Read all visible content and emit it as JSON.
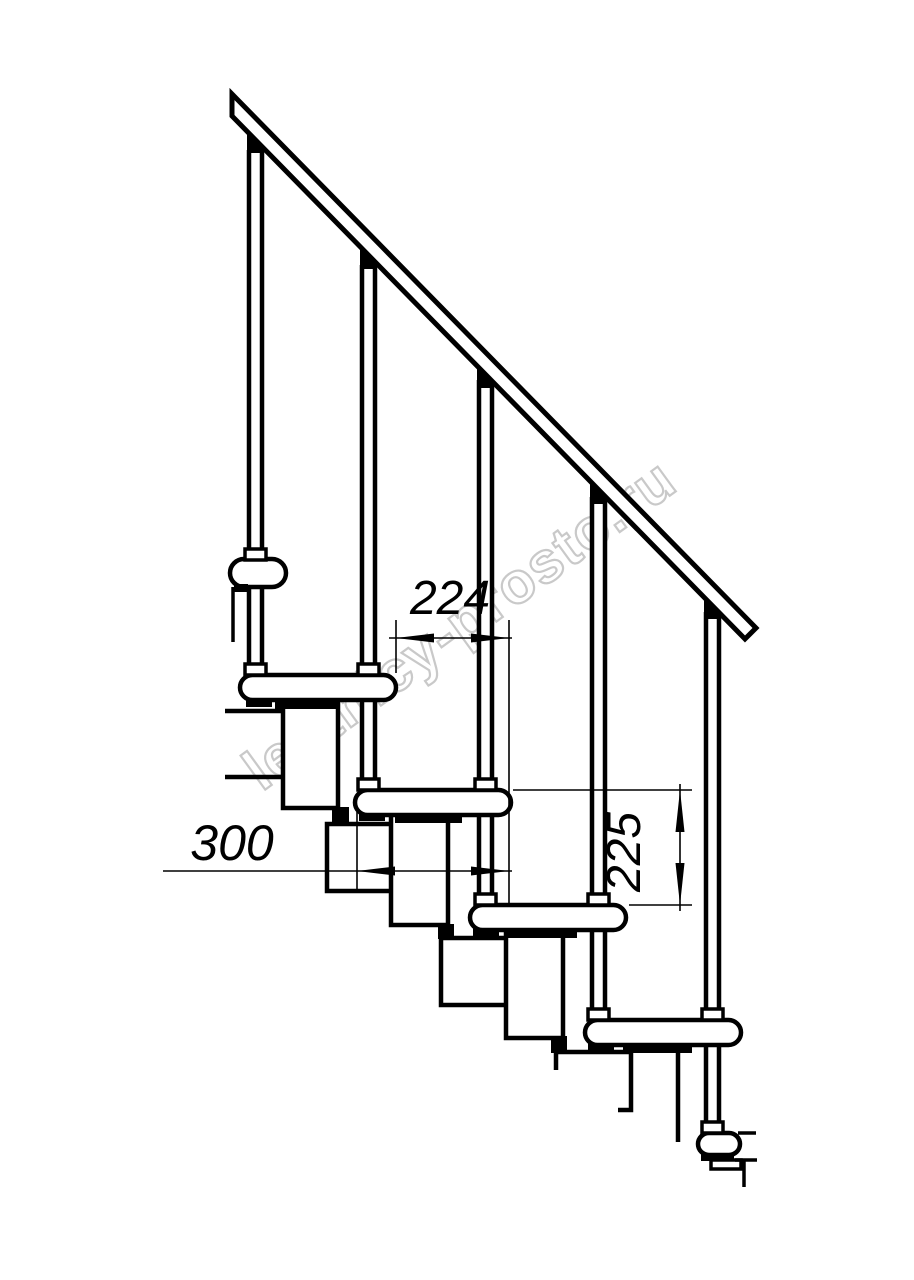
{
  "page": {
    "background": "#ffffff"
  },
  "drawing": {
    "title": "Modular staircase side view technical drawing",
    "line_color": "#000000",
    "watermark": {
      "text": "lestnicy-prosto.ru",
      "color": "#c9c9c9"
    },
    "dimensions": {
      "step_run": {
        "value": "224",
        "orientation": "horizontal"
      },
      "tread_depth": {
        "value": "300",
        "orientation": "horizontal"
      },
      "step_rise": {
        "value": "225",
        "orientation": "vertical"
      }
    },
    "elements": {
      "balusters": 5,
      "treads": 5,
      "handrail": 1
    }
  }
}
